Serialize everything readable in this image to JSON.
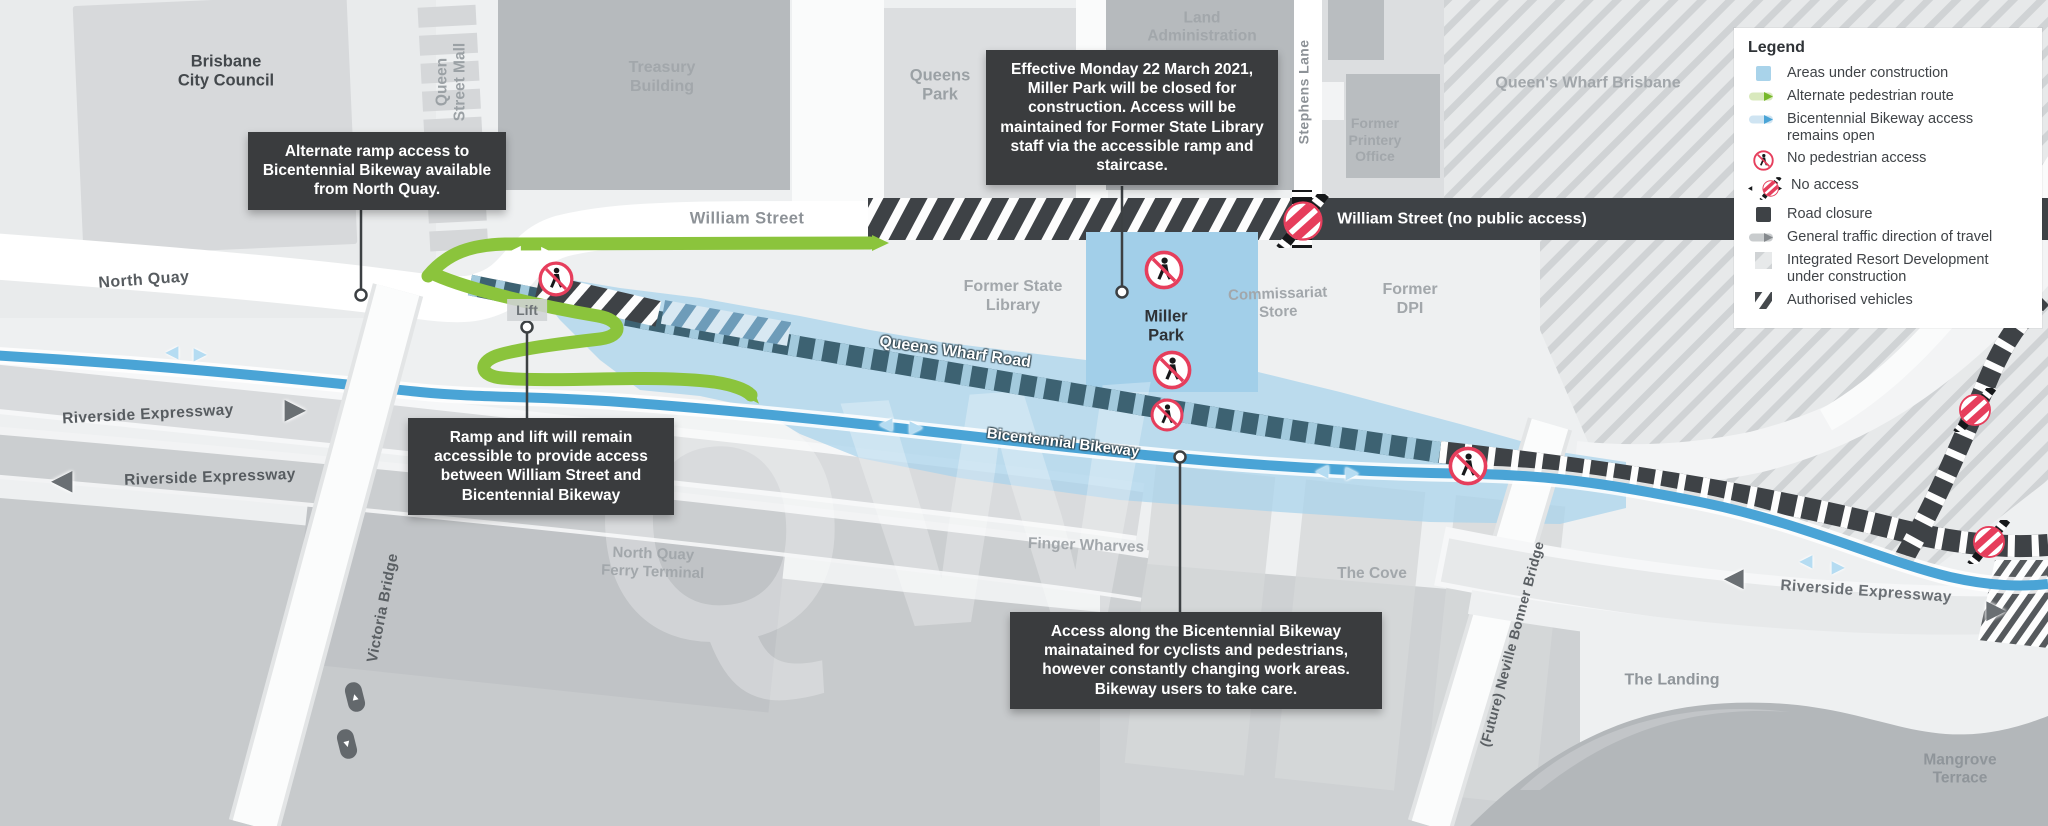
{
  "legend": {
    "title": "Legend",
    "items": [
      {
        "id": "areas-under-construction",
        "label": "Areas under construction"
      },
      {
        "id": "alternate-pedestrian-route",
        "label": "Alternate pedestrian route"
      },
      {
        "id": "bikeway-access-open",
        "label": "Bicentennial Bikeway access remains open"
      },
      {
        "id": "no-pedestrian-access",
        "label": "No pedestrian access"
      },
      {
        "id": "no-access",
        "label": "No access"
      },
      {
        "id": "road-closure",
        "label": "Road closure"
      },
      {
        "id": "general-traffic-direction",
        "label": "General traffic direction of travel"
      },
      {
        "id": "integrated-resort-development",
        "label": "Integrated Resort Development under construction"
      },
      {
        "id": "authorised-vehicles",
        "label": "Authorised vehicles"
      }
    ]
  },
  "callouts": {
    "north_quay_ramp": "Alternate ramp access to Bicentennial Bikeway available from North Quay.",
    "miller_park_closure": "Effective Monday 22 March 2021, Miller Park will be closed for construction. Access will be maintained for Former State Library staff via the accessible ramp and staircase.",
    "ramp_lift": "Ramp and lift will remain accessible to provide access between William Street and Bicentennial Bikeway",
    "bikeway_access": "Access along the Bicentennial Bikeway mainatained for cyclists and pedestrians, however constantly changing work areas. Bikeway users to take care."
  },
  "areas": {
    "brisbane_city_council": "Brisbane\nCity Council",
    "queen_street_mall": "Queen\nStreet Mall",
    "treasury_building": "Treasury\nBuilding",
    "queens_park": "Queens\nPark",
    "land_administration": "Land\nAdministration",
    "stephens_lane": "Stephens Lane",
    "former_printery_office": "Former\nPrintery\nOffice",
    "queens_wharf_brisbane": "Queen's Wharf Brisbane",
    "former_state_library": "Former State\nLibrary",
    "miller_park": "Miller\nPark",
    "commissariat_store": "Commissariat\nStore",
    "former_dpi": "Former\nDPI",
    "north_quay_ferry_terminal": "North Quay\nFerry Terminal",
    "finger_wharves": "Finger Wharves",
    "the_cove": "The Cove",
    "the_landing": "The Landing",
    "mangrove_terrace": "Mangrove\nTerrace",
    "lift": "Lift",
    "watermark": "QW"
  },
  "streets": {
    "north_quay": "North Quay",
    "william_street": "William Street",
    "william_street_closed": "William Street (no public access)",
    "queens_wharf_road": "Queens Wharf Road",
    "bicentennial_bikeway": "Bicentennial Bikeway",
    "riverside_expressway_upper": "Riverside Expressway",
    "riverside_expressway_lower": "Riverside Expressway",
    "riverside_expressway_east": "Riverside Expressway",
    "victoria_bridge": "Victoria Bridge",
    "neville_bonner_bridge": "(Future) Neville Bonner Bridge"
  },
  "colors": {
    "construction_area": "#a9d3ea",
    "pedestrian_route_green": "#8bc43c",
    "bikeway_blue": "#4aa4d6",
    "road_closure_charcoal": "#3e4246",
    "no_access_red": "#e63e5c",
    "callout_background": "#3a3c3e"
  },
  "icons": [
    "no-pedestrian-access-icon",
    "no-access-icon",
    "traffic-direction-arrow-icon",
    "bikeway-direction-arrow-icon",
    "pedestrian-route-arrow-icon",
    "leader-dot"
  ]
}
